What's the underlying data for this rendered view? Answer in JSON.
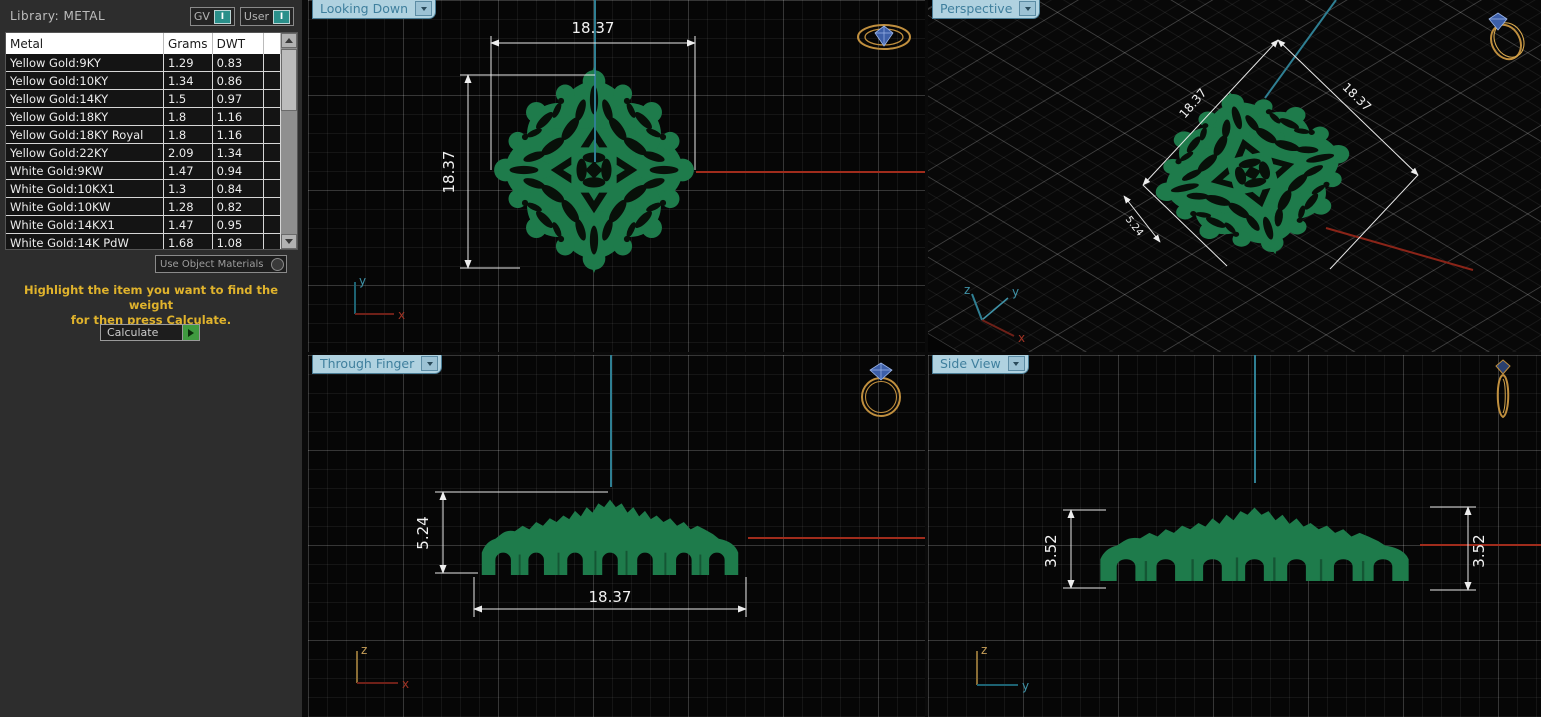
{
  "library_panel": {
    "title": "Library:  METAL",
    "gv_label": "GV",
    "user_label": "User",
    "toggle_value": "I",
    "table": {
      "columns": [
        "Metal",
        "Grams",
        "DWT"
      ],
      "rows": [
        [
          "Yellow Gold:9KY",
          "1.29",
          "0.83"
        ],
        [
          "Yellow Gold:10KY",
          "1.34",
          "0.86"
        ],
        [
          "Yellow Gold:14KY",
          "1.5",
          "0.97"
        ],
        [
          "Yellow Gold:18KY",
          "1.8",
          "1.16"
        ],
        [
          "Yellow Gold:18KY Royal",
          "1.8",
          "1.16"
        ],
        [
          "Yellow Gold:22KY",
          "2.09",
          "1.34"
        ],
        [
          "White Gold:9KW",
          "1.47",
          "0.94"
        ],
        [
          "White Gold:10KX1",
          "1.3",
          "0.84"
        ],
        [
          "White Gold:10KW",
          "1.28",
          "0.82"
        ],
        [
          "White Gold:14KX1",
          "1.47",
          "0.95"
        ],
        [
          "White Gold:14K PdW",
          "1.68",
          "1.08"
        ],
        [
          "White Gold:14KW",
          "1.3",
          "0.84"
        ]
      ]
    },
    "materials_dropdown": "Use Object Materials",
    "instruction_lines": [
      "Highlight the item you want to find the weight",
      "for then press Calculate."
    ],
    "calculate_label": "Calculate"
  },
  "viewports": {
    "looking_down": {
      "label": "Looking Down",
      "dim_width": "18.37",
      "dim_height": "18.37",
      "axis_vertical": "y",
      "axis_horizontal": "x"
    },
    "perspective": {
      "label": "Perspective",
      "dim_left": "18.37",
      "dim_right": "18.37",
      "dim_small": "5.24",
      "axis_up": "z",
      "axis_right": "y",
      "axis_down": "x"
    },
    "through_finger": {
      "label": "Through Finger",
      "dim_height": "5.24",
      "dim_width": "18.37",
      "axis_vertical": "z",
      "axis_horizontal": "x"
    },
    "side_view": {
      "label": "Side View",
      "dim_left": "3.52",
      "dim_right": "3.52",
      "axis_vertical": "z",
      "axis_horizontal": "y"
    }
  },
  "colors": {
    "object_green": "#1e7b4b",
    "dimension_white": "#eeeeee",
    "construction_teal": "#2f7f93",
    "construction_red": "#a02c1c",
    "instruction_yellow": "#e0b32c",
    "tab_blue": "#b0d2e0",
    "calculate_green": "#3f9a3f",
    "toggle_teal": "#2a8f8a"
  }
}
